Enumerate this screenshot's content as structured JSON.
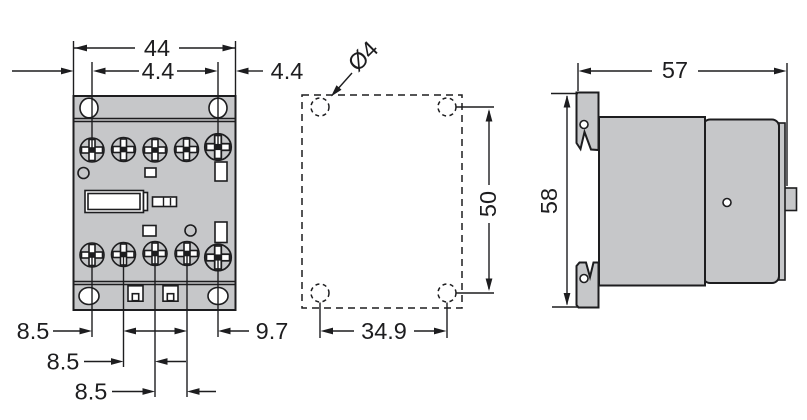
{
  "drawing": {
    "dimensions": {
      "front_width": "44",
      "front_margin_left": "4.4",
      "front_margin_right": "4.4",
      "front_pitch_1": "8.5",
      "front_pitch_2": "8.5",
      "front_pitch_3": "8.5",
      "front_pitch_4": "9.7",
      "plan_hole_diameter": "Ø4",
      "plan_height": "50",
      "plan_width": "34.9",
      "side_width": "57",
      "side_height": "58"
    },
    "colors": {
      "body_fill": "#c6c7c9",
      "line_color": "#1d1d1f",
      "background": "#ffffff"
    }
  }
}
